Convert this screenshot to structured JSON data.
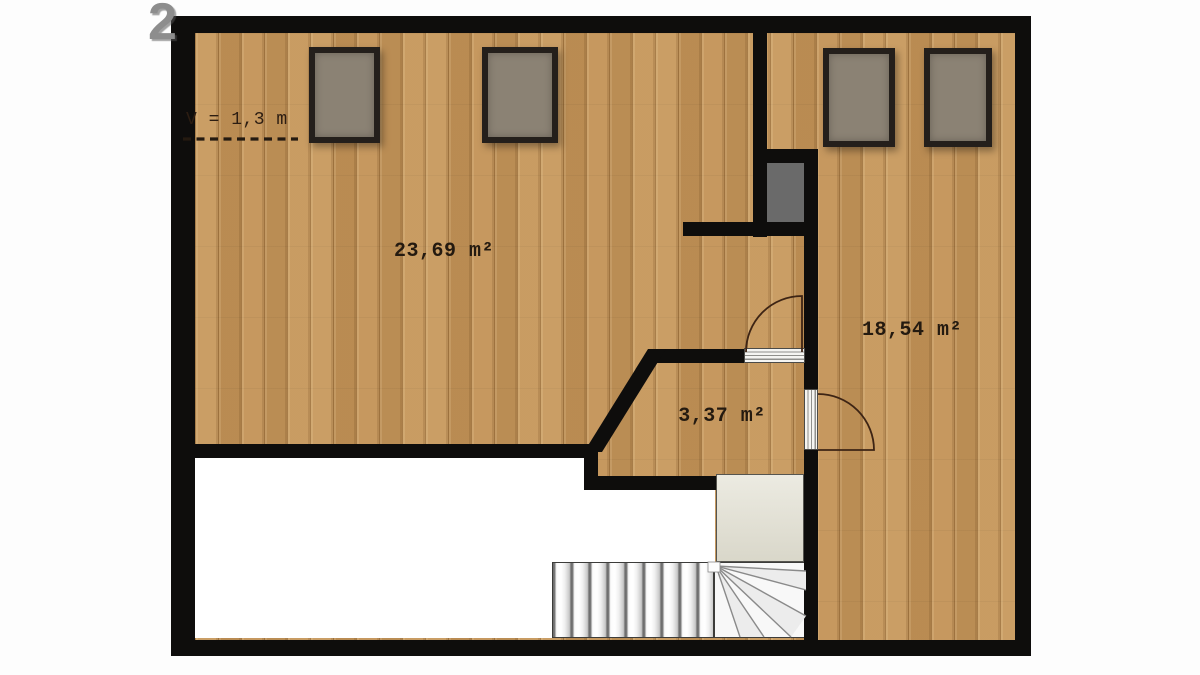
{
  "plan": {
    "watermark": "2",
    "height_note": "V = 1,3 m",
    "rooms": [
      {
        "id": "large-room",
        "area": "23,69 m²"
      },
      {
        "id": "right-room",
        "area": "18,54 m²"
      },
      {
        "id": "hallway",
        "area": "3,37 m²"
      }
    ],
    "features": {
      "windows": 4,
      "doors": 2,
      "staircase": "winder-staircase",
      "shaft": "chimney-shaft",
      "low_headroom_area": "white-area"
    },
    "colors": {
      "wall": "#0e0d0c",
      "wood_floor": "#c4955a",
      "window_glass": "#8b8274",
      "shaft_fill": "#6a6a6a",
      "landing_fill": "#e2e0d2",
      "label_text": "#241a10",
      "door_arc": "#3d2414"
    }
  }
}
